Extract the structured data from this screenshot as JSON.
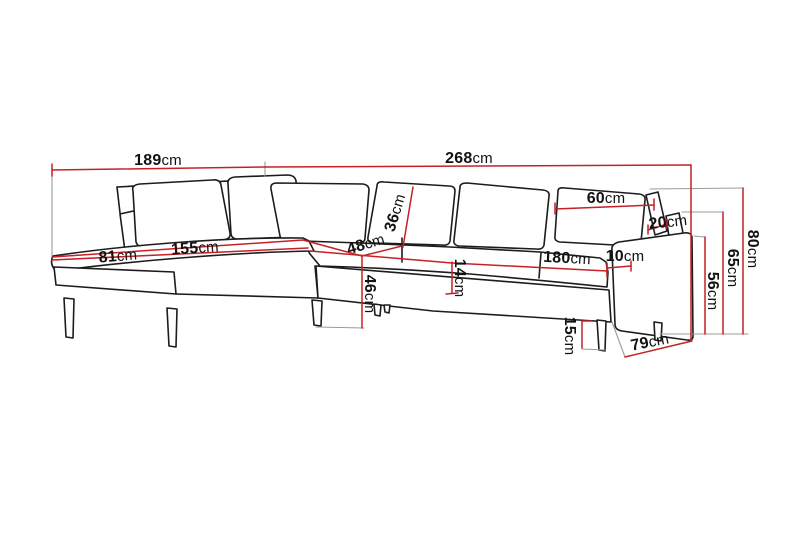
{
  "diagram": {
    "name": "corner-sofa-dimension-diagram",
    "unit": "cm",
    "colors": {
      "dimension_line": "#c42127",
      "sofa_outline": "#1c1c1c",
      "extension_line": "#9b9b9b",
      "background": "#ffffff",
      "text": "#121212"
    },
    "dimensions": {
      "total_depth": {
        "value": "189",
        "unit": "cm"
      },
      "total_width": {
        "value": "268",
        "unit": "cm"
      },
      "back_cushion_width": {
        "value": "60",
        "unit": "cm"
      },
      "armrest_top_width": {
        "value": "20",
        "unit": "cm"
      },
      "total_height": {
        "value": "80",
        "unit": "cm"
      },
      "back_height": {
        "value": "65",
        "unit": "cm"
      },
      "arm_height": {
        "value": "56",
        "unit": "cm"
      },
      "arm_width": {
        "value": "10",
        "unit": "cm"
      },
      "seat_width": {
        "value": "180",
        "unit": "cm"
      },
      "seat_cushion_thickness": {
        "value": "14",
        "unit": "cm"
      },
      "back_cushion_height": {
        "value": "36",
        "unit": "cm"
      },
      "corner_seat_width": {
        "value": "48",
        "unit": "cm"
      },
      "seat_height": {
        "value": "46",
        "unit": "cm"
      },
      "chaise_length": {
        "value": "155",
        "unit": "cm"
      },
      "chaise_width": {
        "value": "81",
        "unit": "cm"
      },
      "leg_height": {
        "value": "15",
        "unit": "cm"
      },
      "side_depth": {
        "value": "79",
        "unit": "cm"
      }
    }
  }
}
